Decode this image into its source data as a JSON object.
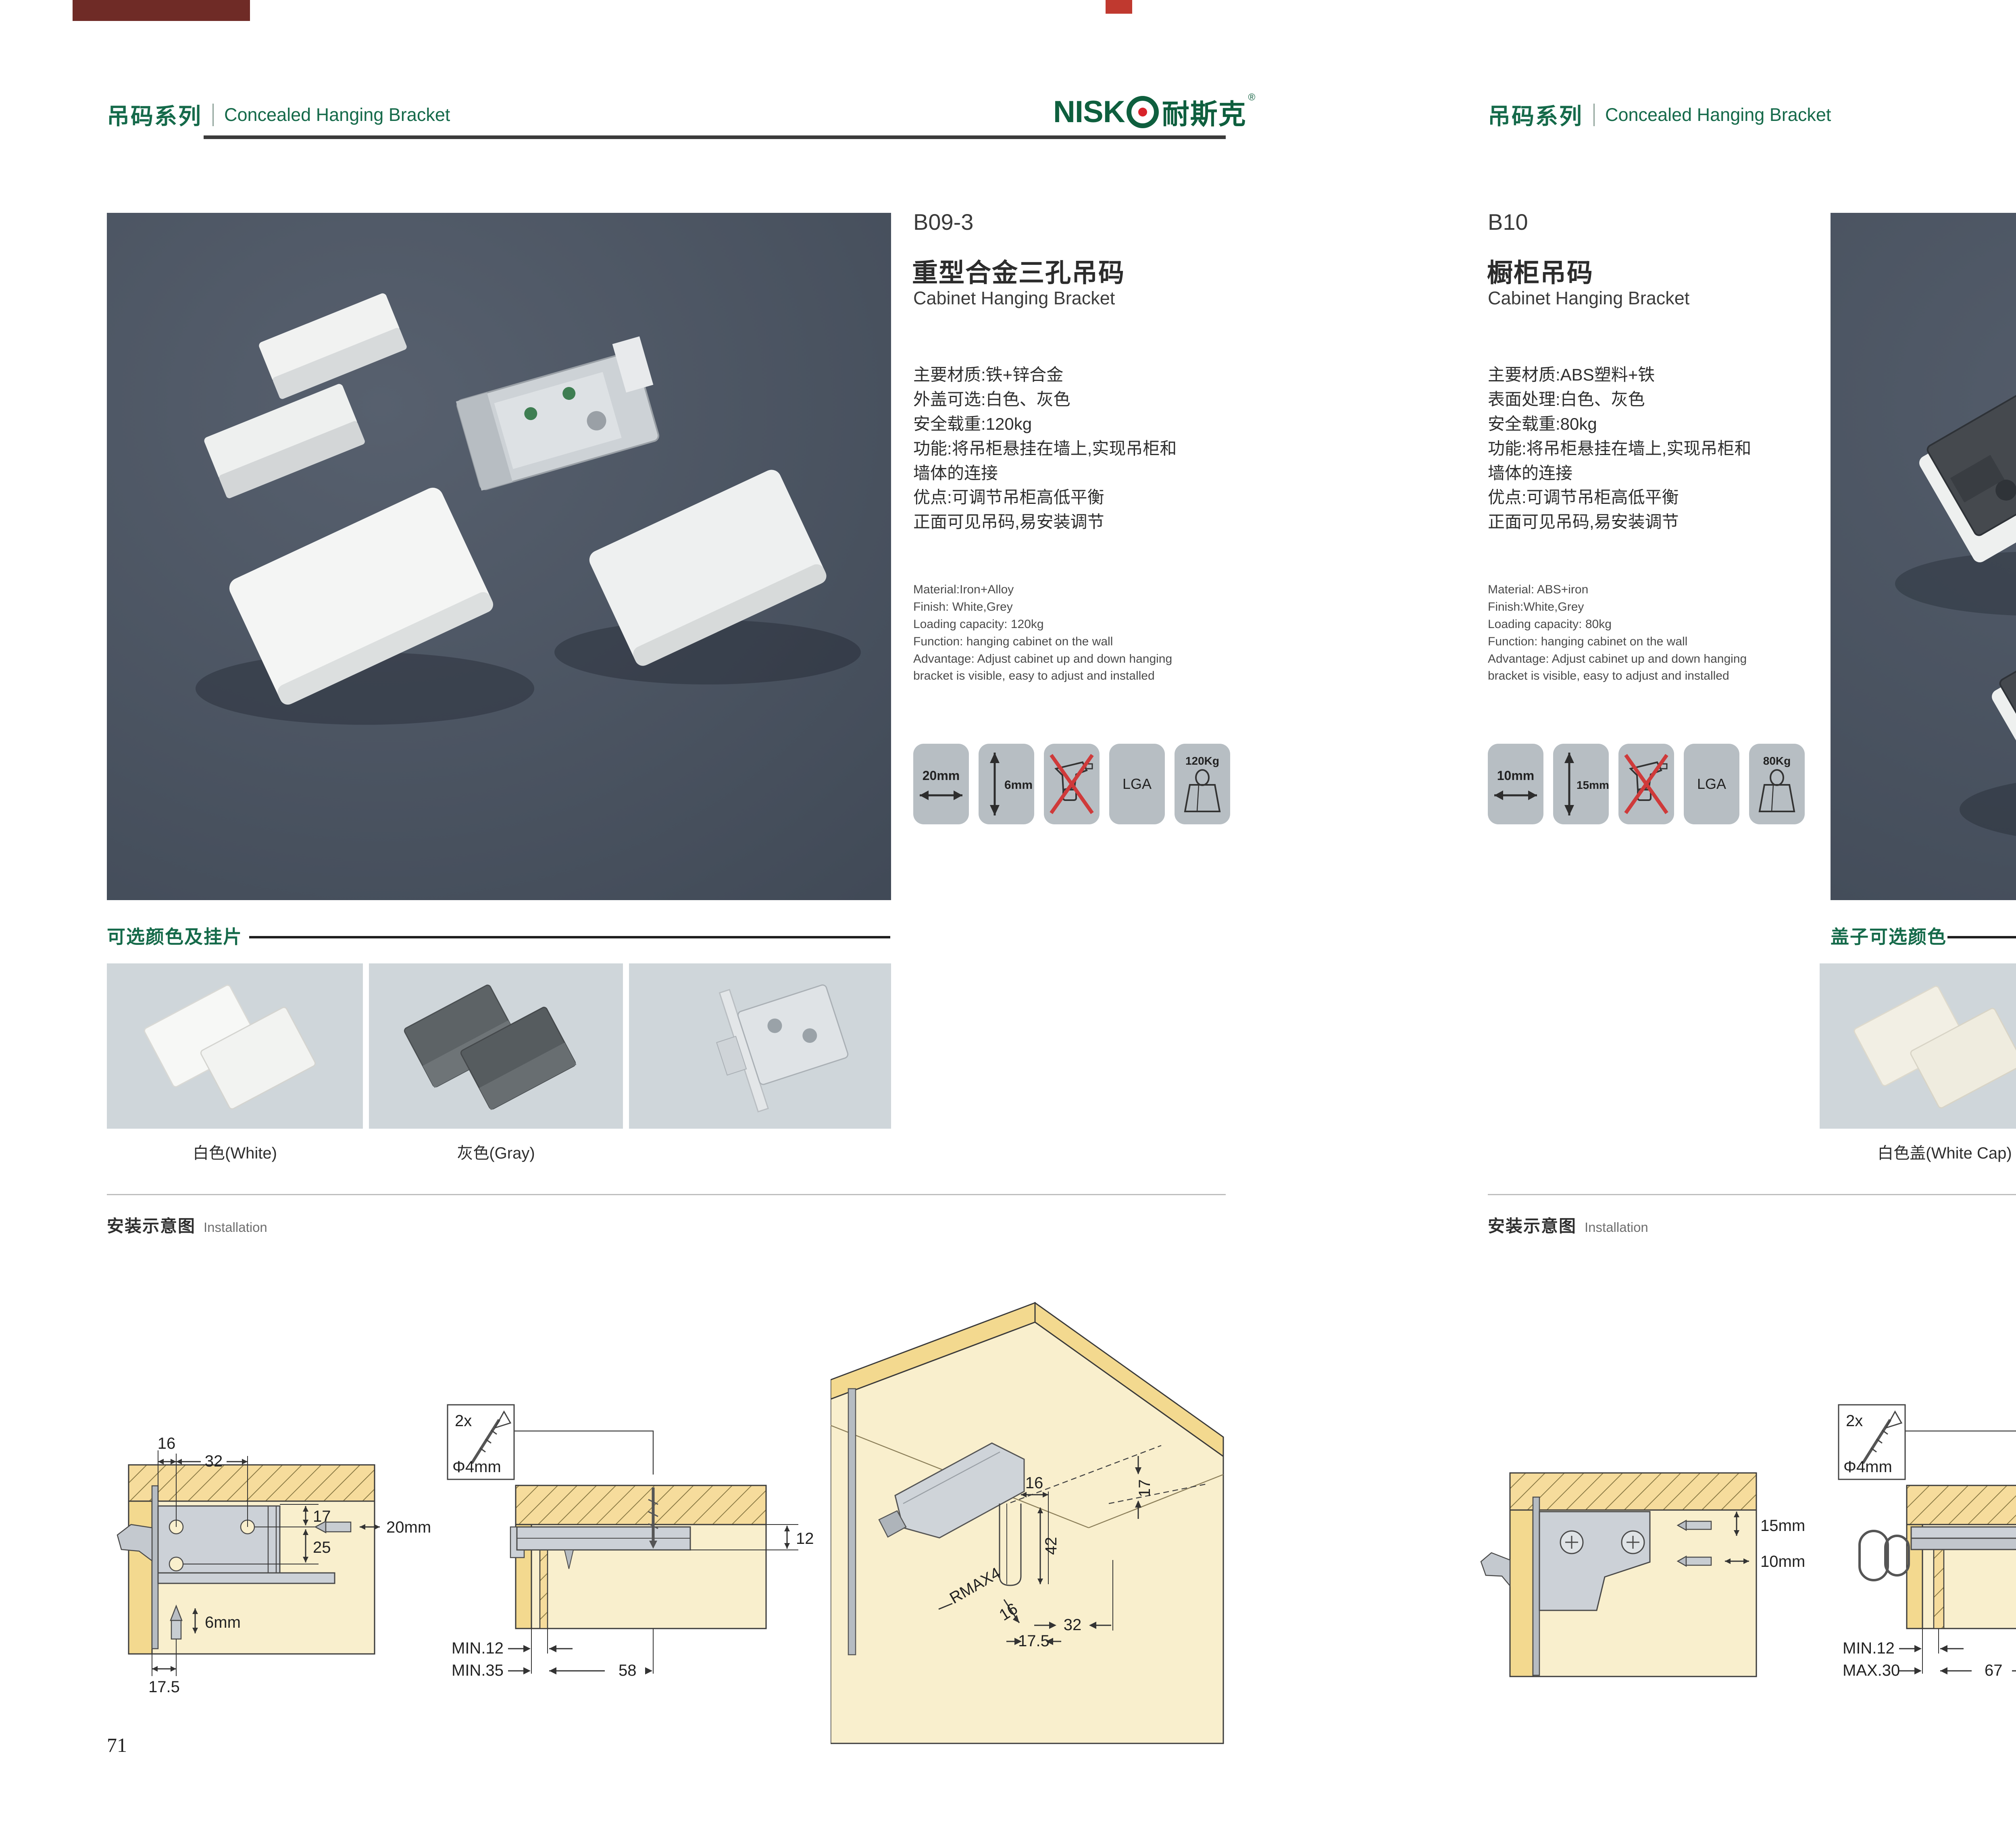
{
  "palette": {
    "brand_green": "#156a4a",
    "logo_green": "#0e5f3e",
    "logo_red": "#d8232a",
    "photo_bg": "#49525f",
    "badge_bg": "#b7bec3",
    "swatch_bg": "#cfd6da",
    "wood_yellow": "#f3d98f",
    "panel_cream": "#f9efcd",
    "no_drill_red": "#cf3a3a"
  },
  "header": {
    "series_cn": "吊码系列",
    "series_en": "Concealed Hanging Bracket"
  },
  "logo": {
    "latin": "NISK",
    "cn": "耐斯克",
    "reg": "®",
    "icon": "target-icon"
  },
  "left": {
    "code": "B09-3",
    "title_cn": "重型合金三孔吊码",
    "title_en": "Cabinet Hanging Bracket",
    "specs_cn": [
      "主要材质:铁+锌合金",
      "外盖可选:白色、灰色",
      "安全载重:120kg",
      "功能:将吊柜悬挂在墙上,实现吊柜和",
      "墙体的连接",
      "优点:可调节吊柜高低平衡",
      "正面可见吊码,易安装调节"
    ],
    "specs_en": [
      "Material:Iron+Alloy",
      "Finish: White,Grey",
      "Loading capacity: 120kg",
      "Function: hanging cabinet on the wall",
      "Advantage: Adjust cabinet up and down hanging",
      "bracket is visible, easy to adjust and installed"
    ],
    "badges": {
      "width": "20mm",
      "height": "6mm",
      "lga": "LGA",
      "load": "120Kg"
    },
    "colors_title": "可选颜色及挂片",
    "swatches": [
      {
        "label": "白色(White)"
      },
      {
        "label": "灰色(Gray)"
      },
      {
        "label": ""
      }
    ],
    "install": {
      "title_cn": "安装示意图",
      "title_en": "Installation",
      "d1": {
        "w1": "16",
        "w2": "32",
        "h1": "17",
        "h2": "25",
        "depth": "20mm",
        "drill": "6mm",
        "off": "17.5"
      },
      "d2": {
        "count": "2x",
        "dia": "Φ4mm",
        "side": "12",
        "row1": "MIN.12",
        "row2": "MIN.35",
        "len": "58"
      },
      "d3": {
        "right": "17",
        "top": "16",
        "mid": "42",
        "r": "RMAX4",
        "low": "16",
        "e": "32",
        "f": "17.5"
      }
    },
    "page_no": "71"
  },
  "right": {
    "code": "B10",
    "title_cn": "橱柜吊码",
    "title_en": "Cabinet Hanging Bracket",
    "specs_cn": [
      "主要材质:ABS塑料+铁",
      "表面处理:白色、灰色",
      "安全载重:80kg",
      "功能:将吊柜悬挂在墙上,实现吊柜和",
      "墙体的连接",
      "优点:可调节吊柜高低平衡",
      "正面可见吊码,易安装调节"
    ],
    "specs_en": [
      "Material: ABS+iron",
      "Finish:White,Grey",
      "Loading capacity: 80kg",
      "Function: hanging cabinet on the wall",
      "Advantage: Adjust cabinet up and down hanging",
      "bracket is visible, easy to adjust and installed"
    ],
    "badges": {
      "width": "10mm",
      "height": "15mm",
      "lga": "LGA",
      "load": "80Kg"
    },
    "colors_title": "盖子可选颜色",
    "swatches": [
      {
        "label": "白色盖(White Cap)"
      },
      {
        "label": "灰色盖(Gray Cap)"
      }
    ],
    "install": {
      "title_cn": "安装示意图",
      "title_en": "Installation",
      "d1": {
        "v": "15mm",
        "h": "10mm"
      },
      "d2": {
        "count": "2x",
        "dia": "Φ4mm",
        "side": "18",
        "row1": "MIN.12",
        "row2": "MAX.30",
        "len": "67"
      },
      "d3": {
        "right": "13",
        "mid": "42",
        "r": "RMAX4",
        "low": "19",
        "e": "17",
        "f": "32"
      }
    },
    "page_no": "72"
  }
}
